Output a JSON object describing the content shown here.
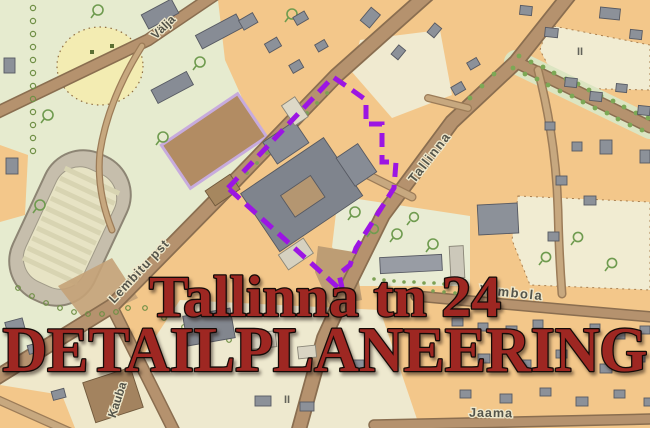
{
  "title": {
    "line1": "Tallinna tn 24",
    "line2": "DETAILPLANEERING"
  },
  "street_labels": {
    "valja": "Välja",
    "tallinna": "Tallinna",
    "lembitu": "Lembitu pst",
    "kauba": "Kauba",
    "vambola": "Vambola",
    "jaama": "Jaama"
  },
  "storey_markers": {
    "block_ne": "II",
    "block_sw": "II"
  },
  "colors": {
    "plan_boundary_purple": "#9c15e3",
    "title_red": "#9e2722",
    "block_orange": "#f3c78a",
    "park_green": "#e6ebcf",
    "road_brown": "#b5926e",
    "building_gray": "#8c9199"
  }
}
